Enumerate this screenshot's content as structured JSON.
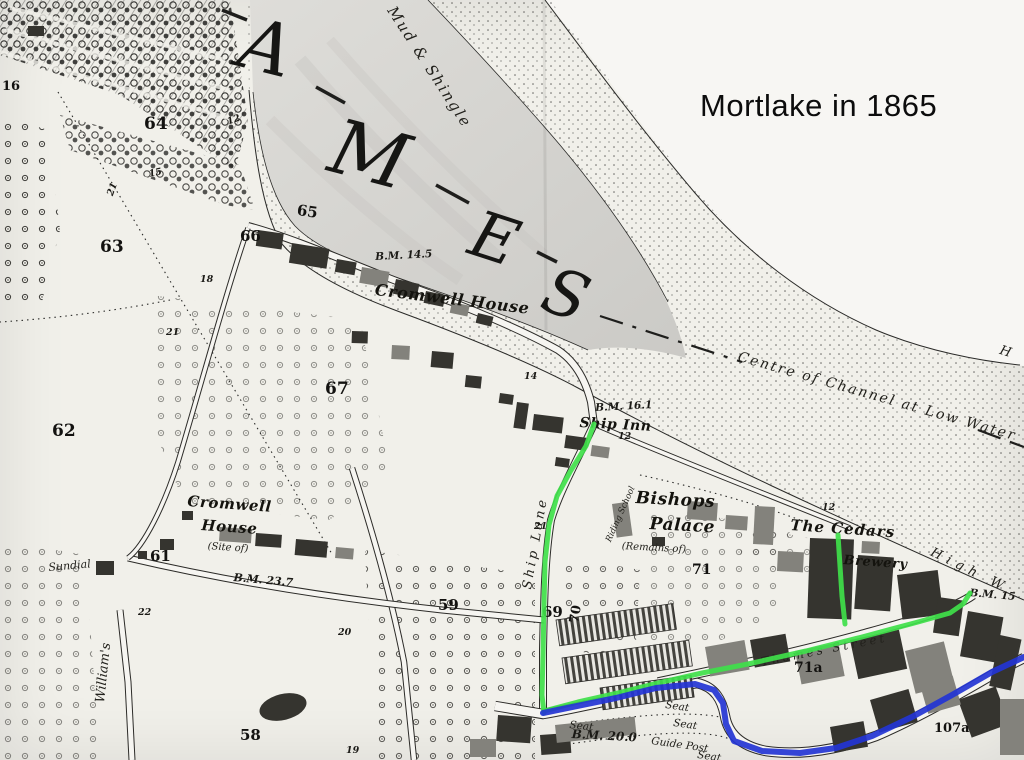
{
  "title": {
    "text": "Mortlake in 1865"
  },
  "map": {
    "colors": {
      "paper": "#f1f0ea",
      "water": "#d6d5d1",
      "ink": "#23221f",
      "route_green": "#3fe04a",
      "route_blue": "#2334d4"
    },
    "labels": [
      {
        "id": "river-letter-t-a",
        "text": "A",
        "cls": "river",
        "x": 250,
        "y": 6,
        "size": 72,
        "rot": 14
      },
      {
        "id": "river-letter-m",
        "text": "M",
        "cls": "river",
        "x": 342,
        "y": 108,
        "size": 76,
        "rot": 15
      },
      {
        "id": "river-letter-e",
        "text": "E",
        "cls": "river",
        "x": 482,
        "y": 202,
        "size": 64,
        "rot": 18
      },
      {
        "id": "river-letter-s",
        "text": "S",
        "cls": "river",
        "x": 556,
        "y": 258,
        "size": 64,
        "rot": 20
      },
      {
        "id": "mud-and-shingle",
        "text": "Mud & Shingle",
        "cls": "terrain",
        "x": 397,
        "y": 4,
        "size": 15,
        "rot": 57,
        "ls": 2
      },
      {
        "id": "centre-of-channel",
        "text": "Centre of Channel at Low Water",
        "cls": "terrain",
        "x": 740,
        "y": 350,
        "size": 14,
        "rot": 16,
        "ls": 2
      },
      {
        "id": "high-water",
        "text": "High W",
        "cls": "terrain",
        "x": 934,
        "y": 546,
        "size": 13,
        "rot": 26,
        "ls": 6
      },
      {
        "id": "high-water-far",
        "text": "H",
        "cls": "terrain",
        "x": 1002,
        "y": 344,
        "size": 13,
        "rot": 18
      },
      {
        "id": "cromwell-house-riverside",
        "text": "Cromwell House",
        "cls": "antique",
        "x": 376,
        "y": 282,
        "size": 16,
        "rot": 7
      },
      {
        "id": "cromwell-house-estate-line1",
        "text": "Cromwell",
        "cls": "antique",
        "x": 188,
        "y": 494,
        "size": 15,
        "rot": 4
      },
      {
        "id": "cromwell-house-estate-line2",
        "text": "House",
        "cls": "antique",
        "x": 202,
        "y": 518,
        "size": 15,
        "rot": 4
      },
      {
        "id": "cromwell-house-estate-line3",
        "text": "(Site of)",
        "cls": "terrain",
        "x": 208,
        "y": 542,
        "size": 10,
        "rot": 4
      },
      {
        "id": "ship-inn",
        "text": "Ship Inn",
        "cls": "antique",
        "x": 580,
        "y": 416,
        "size": 14,
        "rot": 3
      },
      {
        "id": "bishops-palace-line1",
        "text": "Bishops",
        "cls": "antique",
        "x": 636,
        "y": 490,
        "size": 17,
        "rot": 3
      },
      {
        "id": "bishops-palace-line2",
        "text": "Palace",
        "cls": "antique",
        "x": 650,
        "y": 516,
        "size": 17,
        "rot": 3
      },
      {
        "id": "bishops-palace-line3",
        "text": "(Remains of)",
        "cls": "terrain",
        "x": 622,
        "y": 542,
        "size": 10,
        "rot": 3
      },
      {
        "id": "riding-school",
        "text": "Riding School",
        "cls": "terrain",
        "x": 605,
        "y": 540,
        "size": 8.5,
        "rot": -66
      },
      {
        "id": "the-cedars",
        "text": "The Cedars",
        "cls": "antique",
        "x": 791,
        "y": 518,
        "size": 15,
        "rot": 4,
        "ls": 1
      },
      {
        "id": "brewery",
        "text": "Brewery",
        "cls": "antique",
        "x": 844,
        "y": 554,
        "size": 13,
        "rot": 4
      },
      {
        "id": "thames-street",
        "text": "Thames Street",
        "cls": "terrain",
        "x": 760,
        "y": 656,
        "size": 12,
        "rot": -11,
        "ls": 3
      },
      {
        "id": "ship-lane",
        "text": "Ship Lane",
        "cls": "terrain",
        "x": 521,
        "y": 588,
        "size": 13,
        "rot": -80,
        "ls": 3
      },
      {
        "id": "williams-lane",
        "text": "William's",
        "cls": "terrain",
        "x": 94,
        "y": 702,
        "size": 13,
        "rot": -84
      },
      {
        "id": "sundial",
        "text": "Sundial",
        "cls": "terrain",
        "x": 48,
        "y": 562,
        "size": 11,
        "rot": -5
      },
      {
        "id": "seat-1",
        "text": "Seat",
        "cls": "terrain",
        "x": 666,
        "y": 700,
        "size": 10.5,
        "rot": 8
      },
      {
        "id": "seat-2",
        "text": "Seat",
        "cls": "terrain",
        "x": 674,
        "y": 718,
        "size": 10.5,
        "rot": 8
      },
      {
        "id": "seat-3",
        "text": "Seat",
        "cls": "terrain",
        "x": 698,
        "y": 750,
        "size": 10.5,
        "rot": 8
      },
      {
        "id": "seat-4",
        "text": "Seat",
        "cls": "terrain",
        "x": 570,
        "y": 720,
        "size": 10.5,
        "rot": 6
      },
      {
        "id": "guide-post",
        "text": "Guide Post",
        "cls": "terrain",
        "x": 652,
        "y": 736,
        "size": 10.5,
        "rot": 8
      },
      {
        "id": "bm-14-5",
        "text": "B.M. 14.5",
        "cls": "bm",
        "x": 375,
        "y": 252,
        "size": 10.5,
        "rot": -3
      },
      {
        "id": "bm-16-1",
        "text": "B.M. 16.1",
        "cls": "bm",
        "x": 595,
        "y": 403,
        "size": 10.5,
        "rot": -3
      },
      {
        "id": "bm-23-7",
        "text": "B.M. 23.7",
        "cls": "bm",
        "x": 234,
        "y": 572,
        "size": 11,
        "rot": 5
      },
      {
        "id": "bm-20-0",
        "text": "B.M. 20.0",
        "cls": "bm",
        "x": 572,
        "y": 728,
        "size": 12,
        "rot": 3
      },
      {
        "id": "bm-15",
        "text": "B.M. 15",
        "cls": "bm",
        "x": 970,
        "y": 588,
        "size": 10.5,
        "rot": 5
      }
    ],
    "numbers": [
      {
        "id": "parcel-64",
        "text": "64",
        "cls": "num",
        "x": 144,
        "y": 116,
        "size": 17
      },
      {
        "id": "parcel-63",
        "text": "63",
        "cls": "num",
        "x": 100,
        "y": 239,
        "size": 17
      },
      {
        "id": "parcel-62",
        "text": "62",
        "cls": "num",
        "x": 52,
        "y": 423,
        "size": 17
      },
      {
        "id": "parcel-65",
        "text": "65",
        "cls": "num",
        "x": 298,
        "y": 203,
        "size": 15,
        "rot": 8
      },
      {
        "id": "parcel-66",
        "text": "66",
        "cls": "num",
        "x": 240,
        "y": 229,
        "size": 15
      },
      {
        "id": "parcel-67",
        "text": "67",
        "cls": "num",
        "x": 325,
        "y": 381,
        "size": 17
      },
      {
        "id": "parcel-61",
        "text": "61",
        "cls": "num",
        "x": 150,
        "y": 549,
        "size": 15
      },
      {
        "id": "parcel-58",
        "text": "58",
        "cls": "num",
        "x": 240,
        "y": 728,
        "size": 15
      },
      {
        "id": "parcel-59",
        "text": "59",
        "cls": "num",
        "x": 438,
        "y": 598,
        "size": 15
      },
      {
        "id": "parcel-69",
        "text": "69",
        "cls": "num",
        "x": 542,
        "y": 605,
        "size": 15
      },
      {
        "id": "parcel-70",
        "text": "70",
        "cls": "num",
        "x": 568,
        "y": 622,
        "size": 13,
        "rot": -80
      },
      {
        "id": "parcel-71",
        "text": "71",
        "cls": "num",
        "x": 692,
        "y": 563,
        "size": 14
      },
      {
        "id": "parcel-71a",
        "text": "71a",
        "cls": "num",
        "x": 794,
        "y": 661,
        "size": 14
      },
      {
        "id": "parcel-107a",
        "text": "107a",
        "cls": "num",
        "x": 934,
        "y": 722,
        "size": 13
      },
      {
        "id": "parcel-16",
        "text": "16",
        "cls": "num",
        "x": 2,
        "y": 80,
        "size": 13
      },
      {
        "id": "spot-12a",
        "text": "12",
        "cls": "numsm",
        "x": 226,
        "y": 118,
        "rot": -20
      },
      {
        "id": "spot-15",
        "text": "15",
        "cls": "numsm",
        "x": 148,
        "y": 170,
        "rot": -12
      },
      {
        "id": "spot-18",
        "text": "18",
        "cls": "numsm",
        "x": 200,
        "y": 275
      },
      {
        "id": "spot-21a",
        "text": "21",
        "cls": "numsm",
        "x": 106,
        "y": 194,
        "rot": -70
      },
      {
        "id": "spot-21b",
        "text": "21",
        "cls": "numsm",
        "x": 166,
        "y": 328
      },
      {
        "id": "spot-22",
        "text": "22",
        "cls": "numsm",
        "x": 138,
        "y": 608
      },
      {
        "id": "spot-20",
        "text": "20",
        "cls": "numsm",
        "x": 338,
        "y": 628
      },
      {
        "id": "spot-14",
        "text": "14",
        "cls": "numsm",
        "x": 524,
        "y": 372
      },
      {
        "id": "spot-12b",
        "text": "12",
        "cls": "numsm",
        "x": 618,
        "y": 432
      },
      {
        "id": "spot-12c",
        "text": "12",
        "cls": "numsm",
        "x": 822,
        "y": 503
      },
      {
        "id": "spot-21c",
        "text": "21",
        "cls": "numsm",
        "x": 534,
        "y": 522
      },
      {
        "id": "spot-19",
        "text": "19",
        "cls": "numsm",
        "x": 346,
        "y": 746
      }
    ],
    "routes": {
      "green": {
        "color": "#3fe04a",
        "width": 5,
        "paths": [
          {
            "id": "ship-lane-route",
            "points": [
              [
                594,
                424
              ],
              [
                586,
                446
              ],
              [
                570,
                472
              ],
              [
                557,
                496
              ],
              [
                549,
                525
              ],
              [
                545,
                562
              ],
              [
                544,
                605
              ],
              [
                543,
                655
              ],
              [
                542,
                695
              ],
              [
                544,
                713
              ]
            ]
          },
          {
            "id": "thames-street-route",
            "points": [
              [
                544,
                711
              ],
              [
                578,
                702
              ],
              [
                618,
                693
              ],
              [
                658,
                683
              ],
              [
                702,
                673
              ],
              [
                748,
                664
              ],
              [
                806,
                651
              ],
              [
                862,
                637
              ],
              [
                918,
                622
              ],
              [
                950,
                613
              ],
              [
                963,
                604
              ],
              [
                970,
                593
              ]
            ]
          },
          {
            "id": "brewery-path-route",
            "points": [
              [
                838,
                535
              ],
              [
                840,
                566
              ],
              [
                842,
                596
              ],
              [
                845,
                624
              ]
            ]
          }
        ]
      },
      "blue": {
        "color": "#2334d4",
        "width": 6,
        "paths": [
          {
            "id": "high-street-route",
            "points": [
              [
                543,
                713
              ],
              [
                577,
                706
              ],
              [
                616,
                698
              ],
              [
                656,
                688
              ],
              [
                695,
                684
              ],
              [
                714,
                690
              ],
              [
                723,
                703
              ],
              [
                726,
                724
              ],
              [
                734,
                741
              ],
              [
                762,
                751
              ],
              [
                800,
                753
              ],
              [
                836,
                748
              ],
              [
                872,
                736
              ],
              [
                912,
                717
              ],
              [
                952,
                695
              ],
              [
                992,
                672
              ],
              [
                1024,
                657
              ]
            ]
          }
        ]
      }
    }
  }
}
